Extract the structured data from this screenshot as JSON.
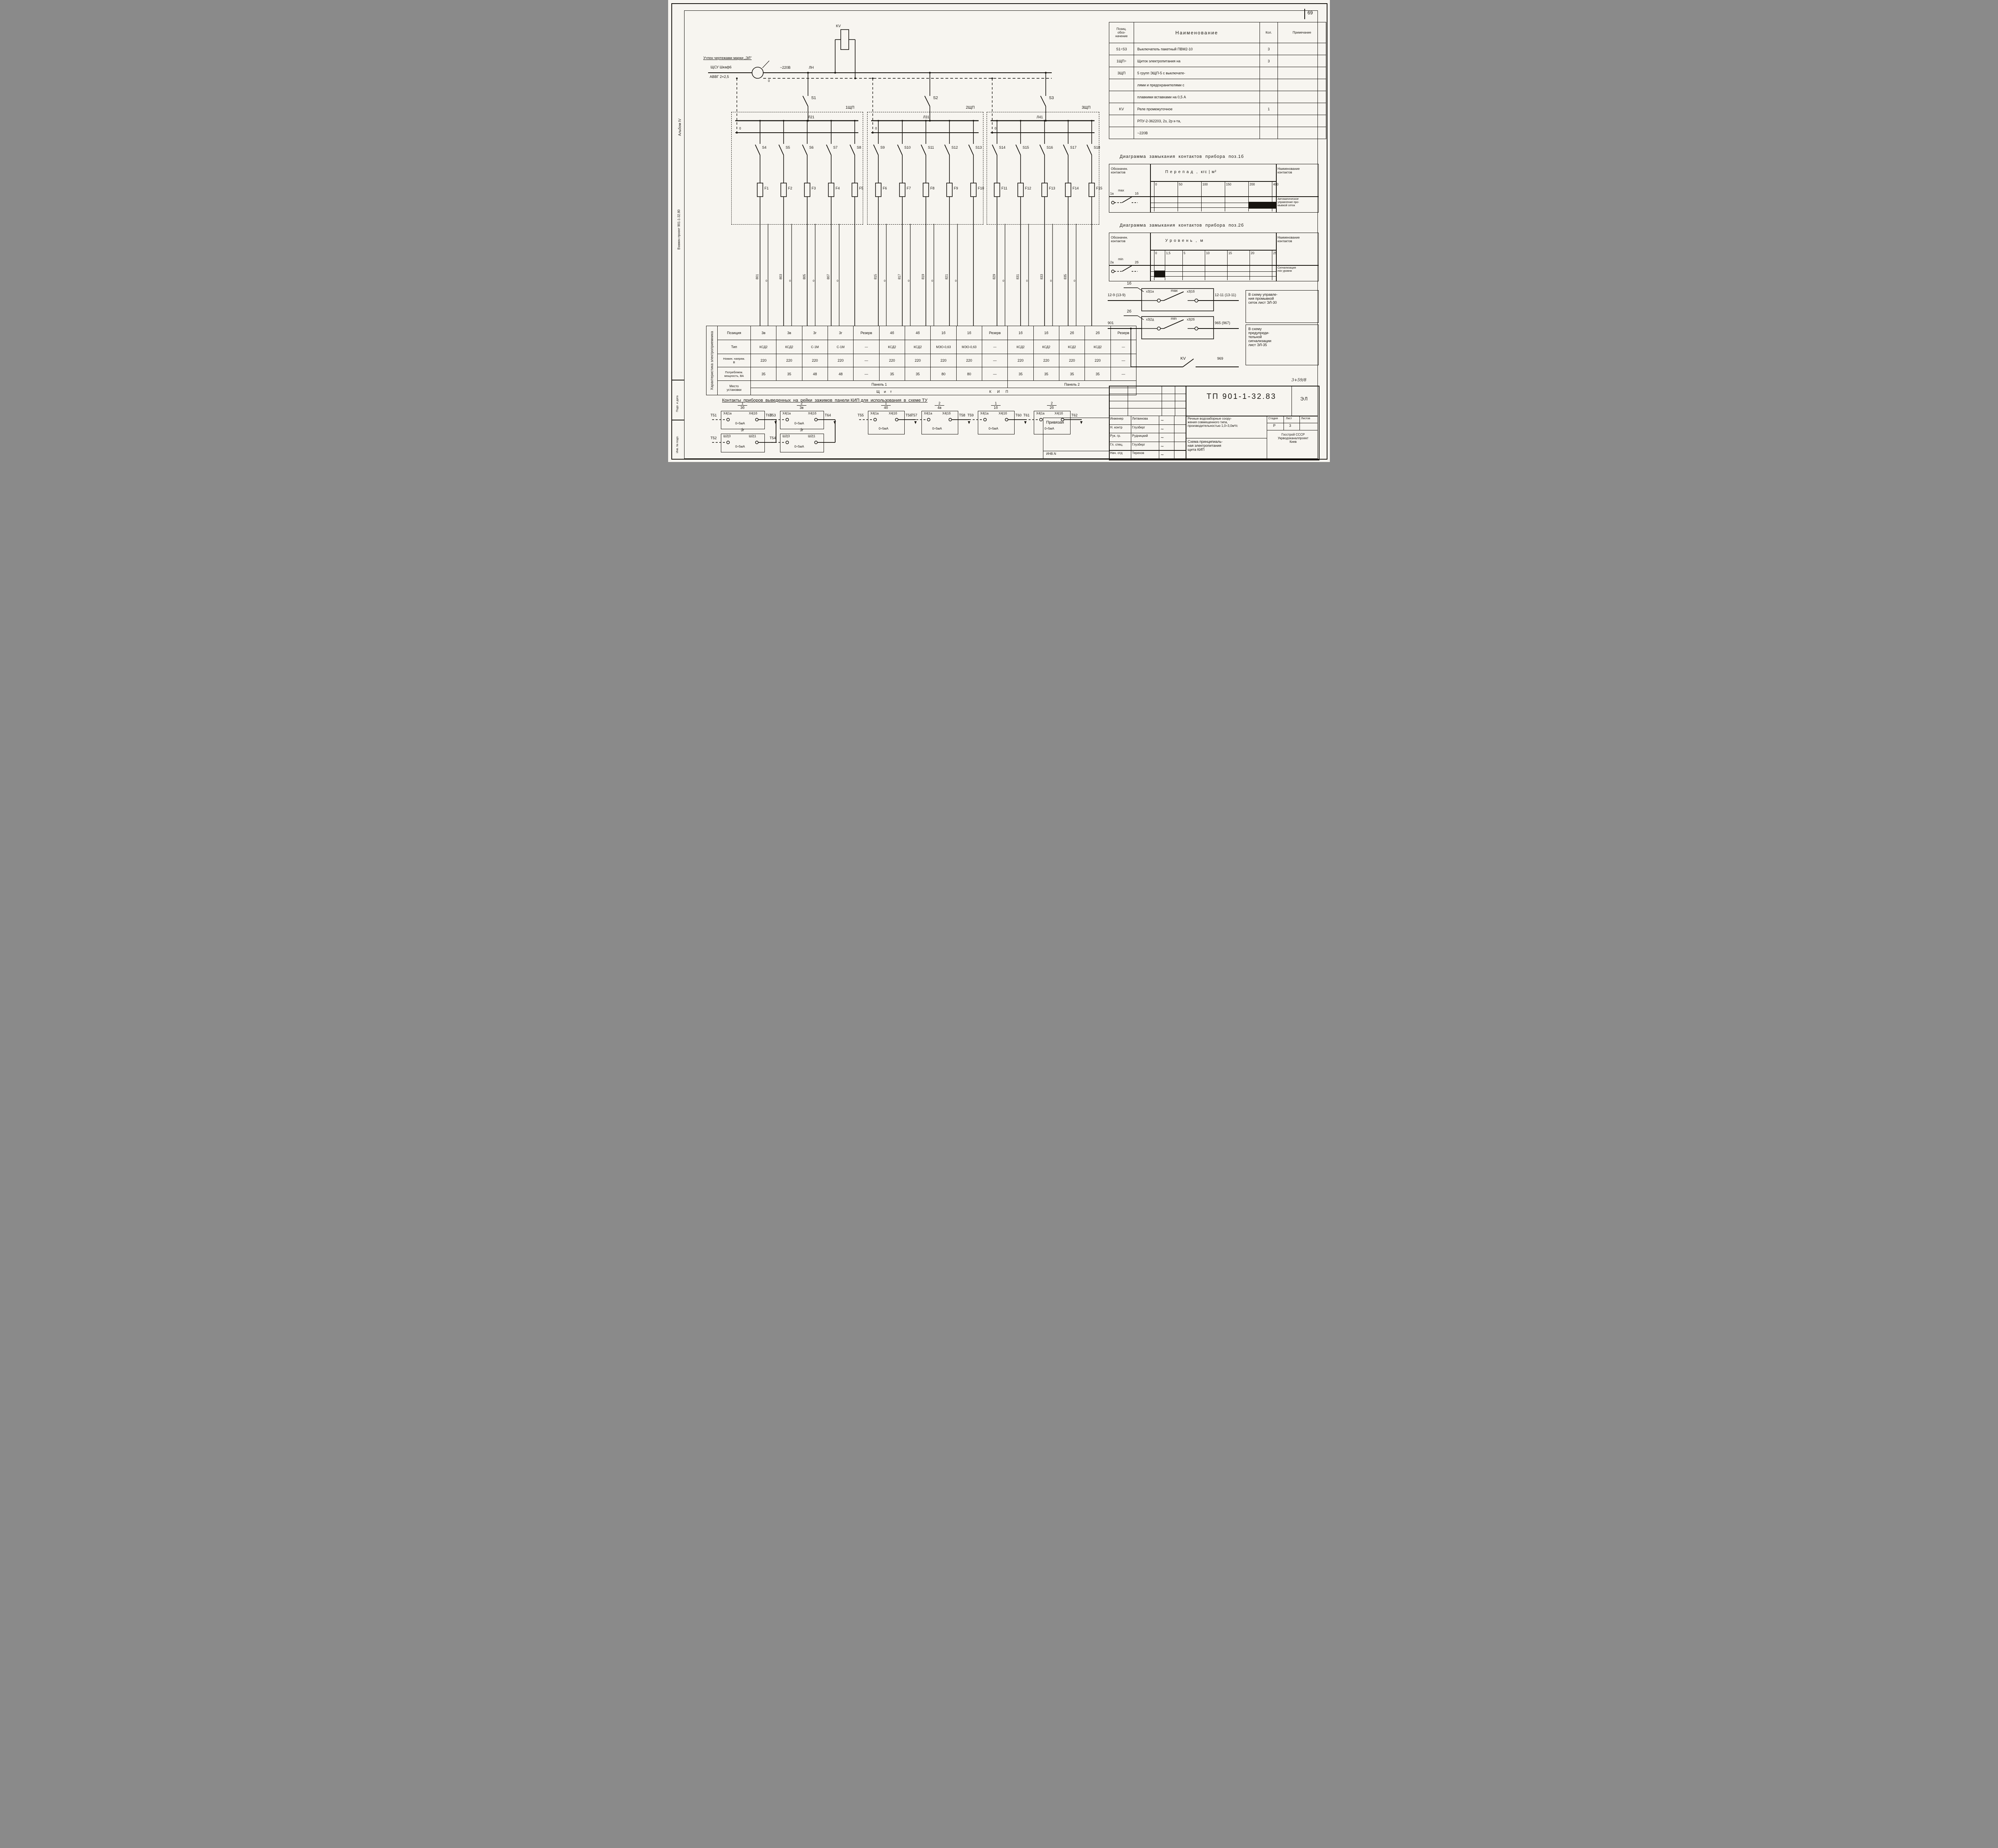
{
  "sheet": {
    "page_number": "69",
    "top_note": "Учтен чертежами марки „ЭЛ\"",
    "ref_note": "3+59/8"
  },
  "margin": {
    "album": "Альбом IV",
    "replaced": "Взамен проект 901-1-32.80",
    "stamp1": "Подп. и дата",
    "stamp2": "Инв. № подл."
  },
  "feed": {
    "source": "ЩСУ Шкаф6",
    "cable": "АВВГ 2×2,5",
    "marker": "Н15",
    "voltage": "~220В",
    "line": "ЛН",
    "neutral": "0",
    "relay": "KV"
  },
  "panels": [
    {
      "name": "1ЩП",
      "switch": "S1",
      "bus": "Л21",
      "zero": "0",
      "branches": [
        {
          "sw": "S4",
          "fuse": "F1",
          "wire": "801"
        },
        {
          "sw": "S5",
          "fuse": "F2",
          "wire": "803"
        },
        {
          "sw": "S6",
          "fuse": "F3",
          "wire": "805"
        },
        {
          "sw": "S7",
          "fuse": "F4",
          "wire": "807"
        },
        {
          "sw": "S8",
          "fuse": "F5",
          "wire": ""
        }
      ]
    },
    {
      "name": "2ЩП",
      "switch": "S2",
      "bus": "Л31",
      "zero": "0",
      "branches": [
        {
          "sw": "S9",
          "fuse": "F6",
          "wire": "815"
        },
        {
          "sw": "S10",
          "fuse": "F7",
          "wire": "817"
        },
        {
          "sw": "S11",
          "fuse": "F8",
          "wire": "819"
        },
        {
          "sw": "S12",
          "fuse": "F9",
          "wire": "821"
        },
        {
          "sw": "S13",
          "fuse": "F10",
          "wire": ""
        }
      ]
    },
    {
      "name": "3ЩП",
      "switch": "S3",
      "bus": "Л41",
      "zero": "0",
      "branches": [
        {
          "sw": "S14",
          "fuse": "F11",
          "wire": "829"
        },
        {
          "sw": "S15",
          "fuse": "F12",
          "wire": "831"
        },
        {
          "sw": "S16",
          "fuse": "F13",
          "wire": "833"
        },
        {
          "sw": "S17",
          "fuse": "F14",
          "wire": "835"
        },
        {
          "sw": "S18",
          "fuse": "F15",
          "wire": ""
        }
      ]
    }
  ],
  "components_table": {
    "headers": [
      "Позиц.\nобоз-\nначение",
      "Наименование",
      "Кол.",
      "Примечание"
    ],
    "rows": [
      [
        "S1÷S3",
        "Выключатель пакетный ПВМ2-10",
        "3",
        ""
      ],
      [
        "1ЩП÷",
        "Щиток  электропитания  на",
        "3",
        ""
      ],
      [
        "3ЩП",
        "5 групп  ЭЩП-5  с  выключате-",
        "",
        ""
      ],
      [
        "",
        "лями  и  предохранителями  с",
        "",
        ""
      ],
      [
        "",
        "плавкими  вставками  на  0,5 А",
        "",
        ""
      ],
      [
        "KV",
        "Реле  промежуточное",
        "1",
        ""
      ],
      [
        "",
        "РПУ-2-362203, 2з, 2р  к-та,",
        "",
        ""
      ],
      [
        "",
        "~220В",
        "",
        ""
      ]
    ]
  },
  "chart_data": [
    {
      "type": "table",
      "title": "Диаграмма  замыкания  контактов  прибора  поз.1б",
      "col1": "Обозначен.\nконтактов",
      "col3": "Наименование\nконтактов",
      "axis": "П е р е п а д  ,  кгс | м²",
      "ticks": [
        "0",
        "50",
        "100",
        "150",
        "200",
        "400"
      ],
      "contact_from": "1а",
      "mode": "max",
      "contact_to": "1б",
      "closed_range": [
        200,
        400
      ],
      "purpose": "Автоматическое\nуправление про-\nмывкой сеток"
    },
    {
      "type": "table",
      "title": "Диаграмма  замыкания  контактов  прибора  поз.2б",
      "col1": "Обозначен.\nконтактов",
      "col3": "Наименование\nконтактов",
      "axis": "У р о в е н ь  ,  м",
      "ticks": [
        "0",
        "1,5",
        "5",
        "10",
        "15",
        "20",
        "25"
      ],
      "contact_from": "2а",
      "mode": "min",
      "contact_to": "2б",
      "closed_range": [
        0,
        1.5
      ],
      "purpose": "Сигнализация\nmin  уровня"
    }
  ],
  "contact_circuits": [
    {
      "pos": "1б",
      "left": "12-9 (13-9)",
      "c1": "х3|1а",
      "mode": "max",
      "c2": "х3|1б",
      "right": "12-11 (13-11)",
      "note": "В схему управле-\nния  промывкой\nсеток  лист ЭЛ-30"
    },
    {
      "pos": "2б",
      "left": "901",
      "c1": "х3|2д",
      "mode": "min",
      "c2": "х3|2б",
      "right": "965 (967)",
      "note": "В  схему\nпредупреди-\nтельной\nсигнализации\nлист ЭЛ-35"
    }
  ],
  "kv_circuit": {
    "label": "KV",
    "wire": "969"
  },
  "load_table": {
    "rot_header": "Характеристика электроприемника",
    "row_labels": [
      "Позиция",
      "Тип",
      "Номин. напряж.\nВ",
      "Потребляем.\nмощность, ВА",
      "Место\nустановки"
    ],
    "positions": [
      "3в",
      "3в",
      "3г",
      "3г",
      "Резерв",
      "4б",
      "4б",
      "1б",
      "1б",
      "Резерв",
      "1б",
      "1б",
      "2б",
      "2б",
      "Резерв"
    ],
    "types": [
      "КСД2",
      "КСД2",
      "С-1М",
      "С-1М",
      "—",
      "КСД2",
      "КСД2",
      "МЭО-0,63",
      "МЭО-0,63",
      "—",
      "КСД2",
      "КСД2",
      "КСД2",
      "КСД2",
      "—"
    ],
    "voltages": [
      "220",
      "220",
      "220",
      "220",
      "—",
      "220",
      "220",
      "220",
      "220",
      "—",
      "220",
      "220",
      "220",
      "220",
      "—"
    ],
    "powers": [
      "35",
      "35",
      "48",
      "48",
      "—",
      "35",
      "35",
      "80",
      "80",
      "—",
      "35",
      "35",
      "35",
      "35",
      "—"
    ],
    "panel1": "Панель 1",
    "panel2": "Панель 2",
    "shield": "Щ и т",
    "kip": "К И П"
  },
  "terminals": {
    "heading": "Контакты  приборов  выведенных  на  рейки  зажимов  панели КИП для  использования  в  схеме ТУ",
    "range": "0÷5мА",
    "groups": [
      {
        "num": "1",
        "pos": "3б",
        "left": "Т51",
        "right": "Т63",
        "c1": "Х4|1а",
        "c2": "Х4|1б",
        "sub": {
          "pos": "3г",
          "left": "Т52",
          "c1": "Ш2|3",
          "c2": "Ш2|1"
        }
      },
      {
        "num": "2",
        "pos": "3в",
        "left": "Т53",
        "right": "Т64",
        "c1": "Х4|1а",
        "c2": "Х4|1б",
        "sub": {
          "pos": "3г",
          "left": "Т54",
          "c1": "Ш2|3",
          "c2": "Ш2|1"
        }
      },
      {
        "num": "1",
        "pos": "4б",
        "left": "Т55",
        "right": "Т56",
        "c1": "Х4|1а",
        "c2": "Х4|1б"
      },
      {
        "num": "2",
        "pos": "4в",
        "left": "Т57",
        "right": "Т58",
        "c1": "Х4|1а",
        "c2": "Х4|1б"
      },
      {
        "num": "1",
        "pos": "1б",
        "left": "Т59",
        "right": "Т60",
        "c1": "Х4|1а",
        "c2": "Х4|1б"
      },
      {
        "num": "2",
        "pos": "2б",
        "left": "Т61",
        "right": "Т62",
        "c1": "Х4|1а",
        "c2": "Х4|1б"
      }
    ]
  },
  "title_block": {
    "doc_number": "ТП 901-1-32.83",
    "mark": "ЭЛ",
    "project": "Речные  водозаборные  соору-\nжения  совмещенного  типа,\nпроизводительностью 1,0÷3,0м³/с",
    "drawing_title": "Схема  принципиаль-\nная  электропитания\nщита  КИП",
    "stage_headers": [
      "Стадия",
      "Лист",
      "Листов"
    ],
    "stage_values": [
      "Р",
      "3",
      ""
    ],
    "org": "Госстрой СССР\nУкрводоканалпроект\nКиев",
    "signatures": [
      [
        "Инженер",
        "Литвинова"
      ],
      [
        "Н. контр",
        "Глузберг"
      ],
      [
        "Рук. гр.",
        "Рудницкий"
      ],
      [
        "Гл. спец.",
        "Глузберг"
      ],
      [
        "Нач. отд",
        "Терехов"
      ]
    ],
    "attached": "Привязан",
    "inv": "ИНВ.N"
  }
}
